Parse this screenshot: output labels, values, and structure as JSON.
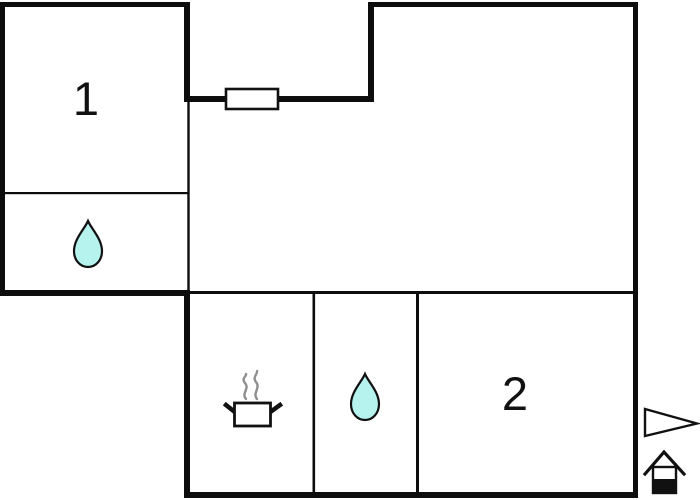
{
  "floorplan": {
    "background_color": "#ffffff",
    "wall_color": "#0d0d0d",
    "rooms": [
      {
        "label": "1"
      },
      {
        "label": "2"
      }
    ],
    "symbols": {
      "icons": [
        "water-drop-icon",
        "water-drop-icon",
        "cooking-pot-icon",
        "window-symbol",
        "direction-arrow-icon",
        "entrance-house-icon"
      ],
      "water_drop_fill": "#b6f2ee",
      "water_drop_outline": "#111111",
      "steam_color": "#8f8f8f",
      "symbol_fill": "#ffffff",
      "symbol_outline": "#111111"
    }
  }
}
